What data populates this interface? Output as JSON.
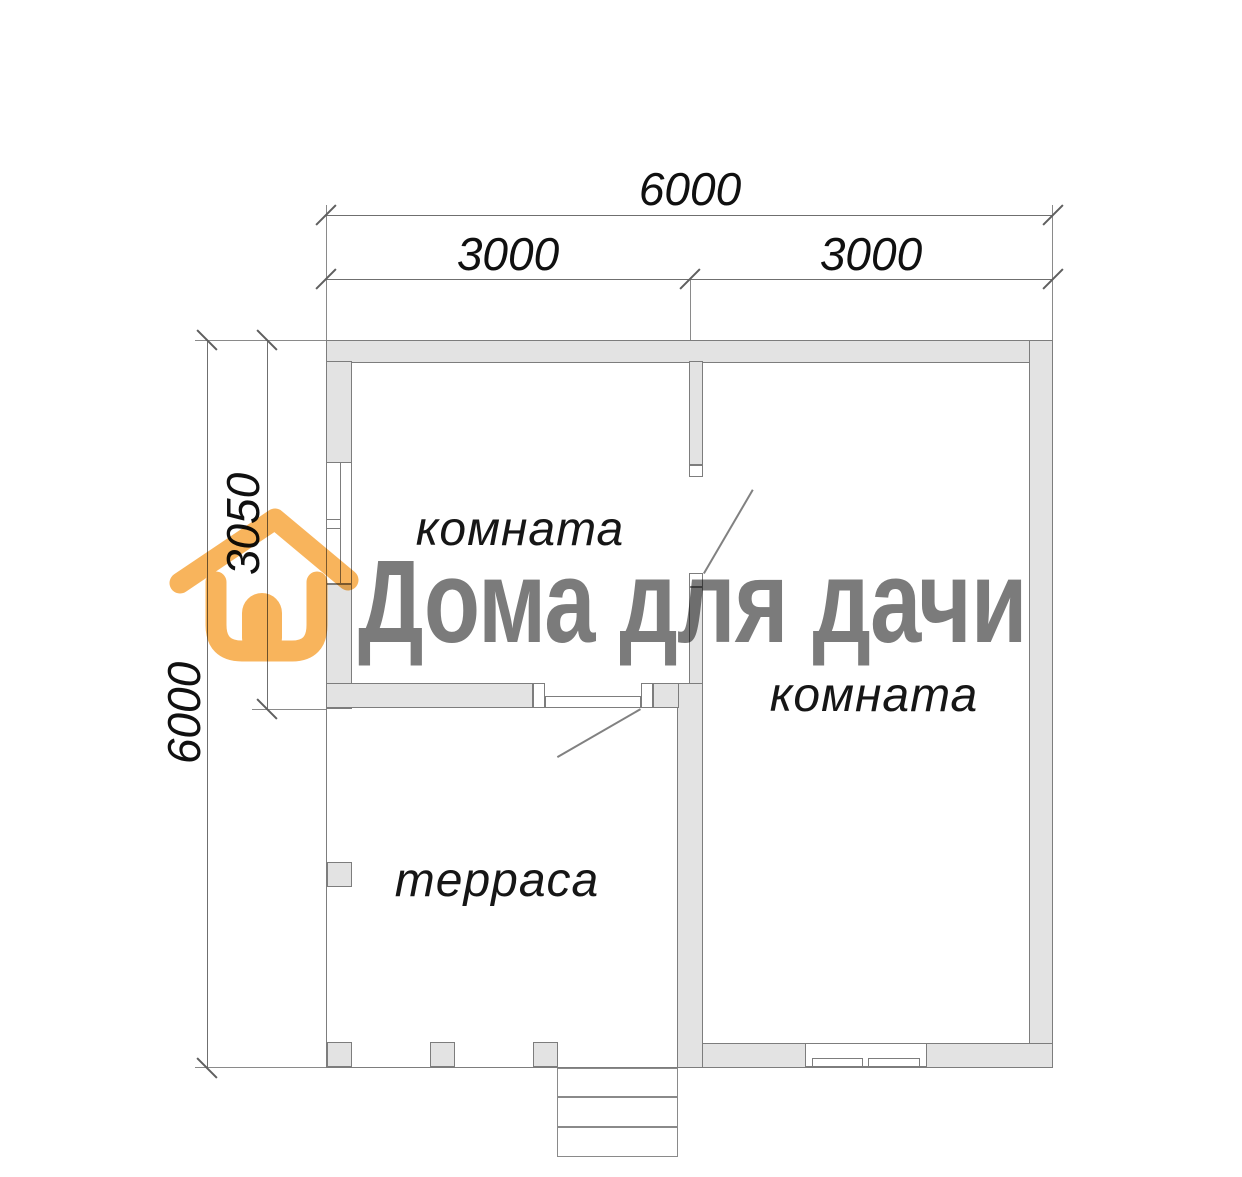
{
  "brand": {
    "name": "Дома для дачи",
    "icon": "house-icon",
    "accent_color": "#F8B45C",
    "text_color": "#7B7B7B"
  },
  "dimensions": {
    "top_total": "6000",
    "top_left_span": "3000",
    "top_right_span": "3000",
    "side_total": "6000",
    "side_room_span": "3050"
  },
  "rooms": {
    "room_top_left": "комната",
    "room_right": "комната",
    "terrace": "терраса"
  },
  "colors": {
    "wall_fill": "#E3E3E3",
    "wall_outline": "#7D7D7D",
    "dimension_lines": "#6F6F6F",
    "label_text": "#101010"
  }
}
